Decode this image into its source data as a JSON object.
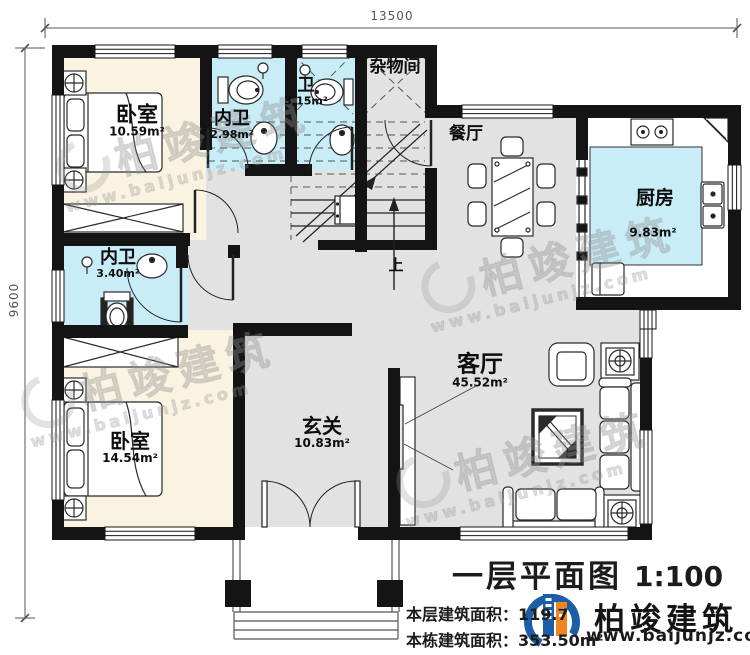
{
  "dimensions": {
    "top": "13500",
    "left": "9600"
  },
  "rooms": [
    {
      "id": "bedroom-1",
      "name": "卧室",
      "area": "10.59m²"
    },
    {
      "id": "bath-inner-1",
      "name": "内卫",
      "area": "2.98m²"
    },
    {
      "id": "bath",
      "name": "卫",
      "area": "3.15m²"
    },
    {
      "id": "storage",
      "name": "杂物间",
      "area": ""
    },
    {
      "id": "dining",
      "name": "餐厅",
      "area": ""
    },
    {
      "id": "kitchen",
      "name": "厨房",
      "area": "9.83m²"
    },
    {
      "id": "bath-inner-2",
      "name": "内卫",
      "area": "3.40m²"
    },
    {
      "id": "bedroom-2",
      "name": "卧室",
      "area": "14.54m²"
    },
    {
      "id": "foyer",
      "name": "玄关",
      "area": "10.83m²"
    },
    {
      "id": "living",
      "name": "客厅",
      "area": "45.52m²"
    }
  ],
  "stairs": {
    "up_label": "上"
  },
  "title_block": {
    "title": "一层平面图",
    "scale": "1:100",
    "floor_area_label": "本层建筑面积：",
    "floor_area_value": "119.7",
    "building_area_label": "本栋建筑面积：",
    "building_area_value": "353.50m²"
  },
  "logo": {
    "name": "柏竣建筑",
    "website": "www.baijunjz.com",
    "colors": {
      "blue": "#1b5ea6",
      "orange": "#ef8420"
    }
  },
  "watermark": {
    "name": "柏竣建筑",
    "website": "www.baijunjz.com"
  },
  "palette": {
    "wall": "#141414",
    "floor_gray": "#e2e2e2",
    "bedroom_cream": "#faf3e1",
    "wet_cyan": "#c9edf7",
    "line": "#222222"
  }
}
